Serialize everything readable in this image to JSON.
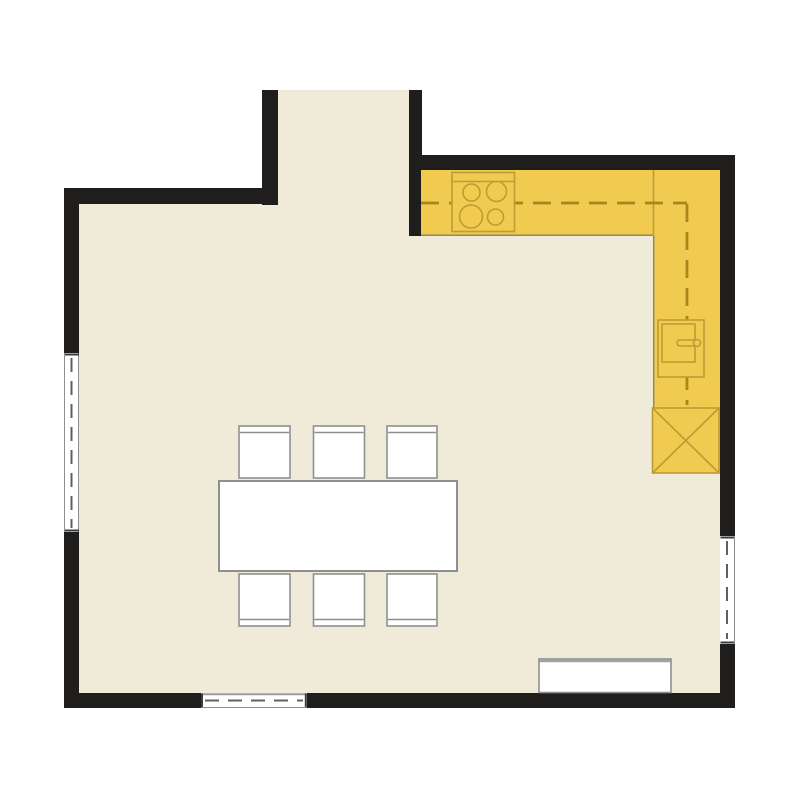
{
  "title": "kitchen-dining-floor-plan",
  "colors": {
    "background": "#ffffff",
    "wall": "#201e1c",
    "floor": "#f0ead9",
    "counter": "#f1ca50",
    "counter_edge": "#8f8a5c",
    "fixture_outline": "#bd9c33",
    "dash": "#a8861e",
    "furniture_fill": "#ffffff",
    "furniture_border": "#8f8f8f",
    "window_fill": "#ffffff",
    "window_dash": "#5f5f5f",
    "window_end": "#3c3c3c",
    "window_frame": "#9a9a9a",
    "sideboard_top": "#a3a3a3"
  },
  "plan": {
    "type": "floor-plan",
    "rooms": [
      "main-room",
      "hallway-opening-top"
    ],
    "fixtures": [
      {
        "name": "kitchen-counter",
        "shape": "L",
        "position": "top-right",
        "centerline": "dashed"
      },
      {
        "name": "hob",
        "burners": 4,
        "position": "top-counter"
      },
      {
        "name": "oven-unit",
        "position": "right-counter"
      },
      {
        "name": "appliance-crossed-box",
        "position": "right-counter-end"
      },
      {
        "name": "dining-table",
        "chairs": 6,
        "position": "center-left"
      },
      {
        "name": "sideboard",
        "position": "bottom-right"
      },
      {
        "name": "window",
        "count": 3,
        "positions": [
          "left-wall",
          "right-wall",
          "bottom-wall"
        ]
      }
    ]
  }
}
